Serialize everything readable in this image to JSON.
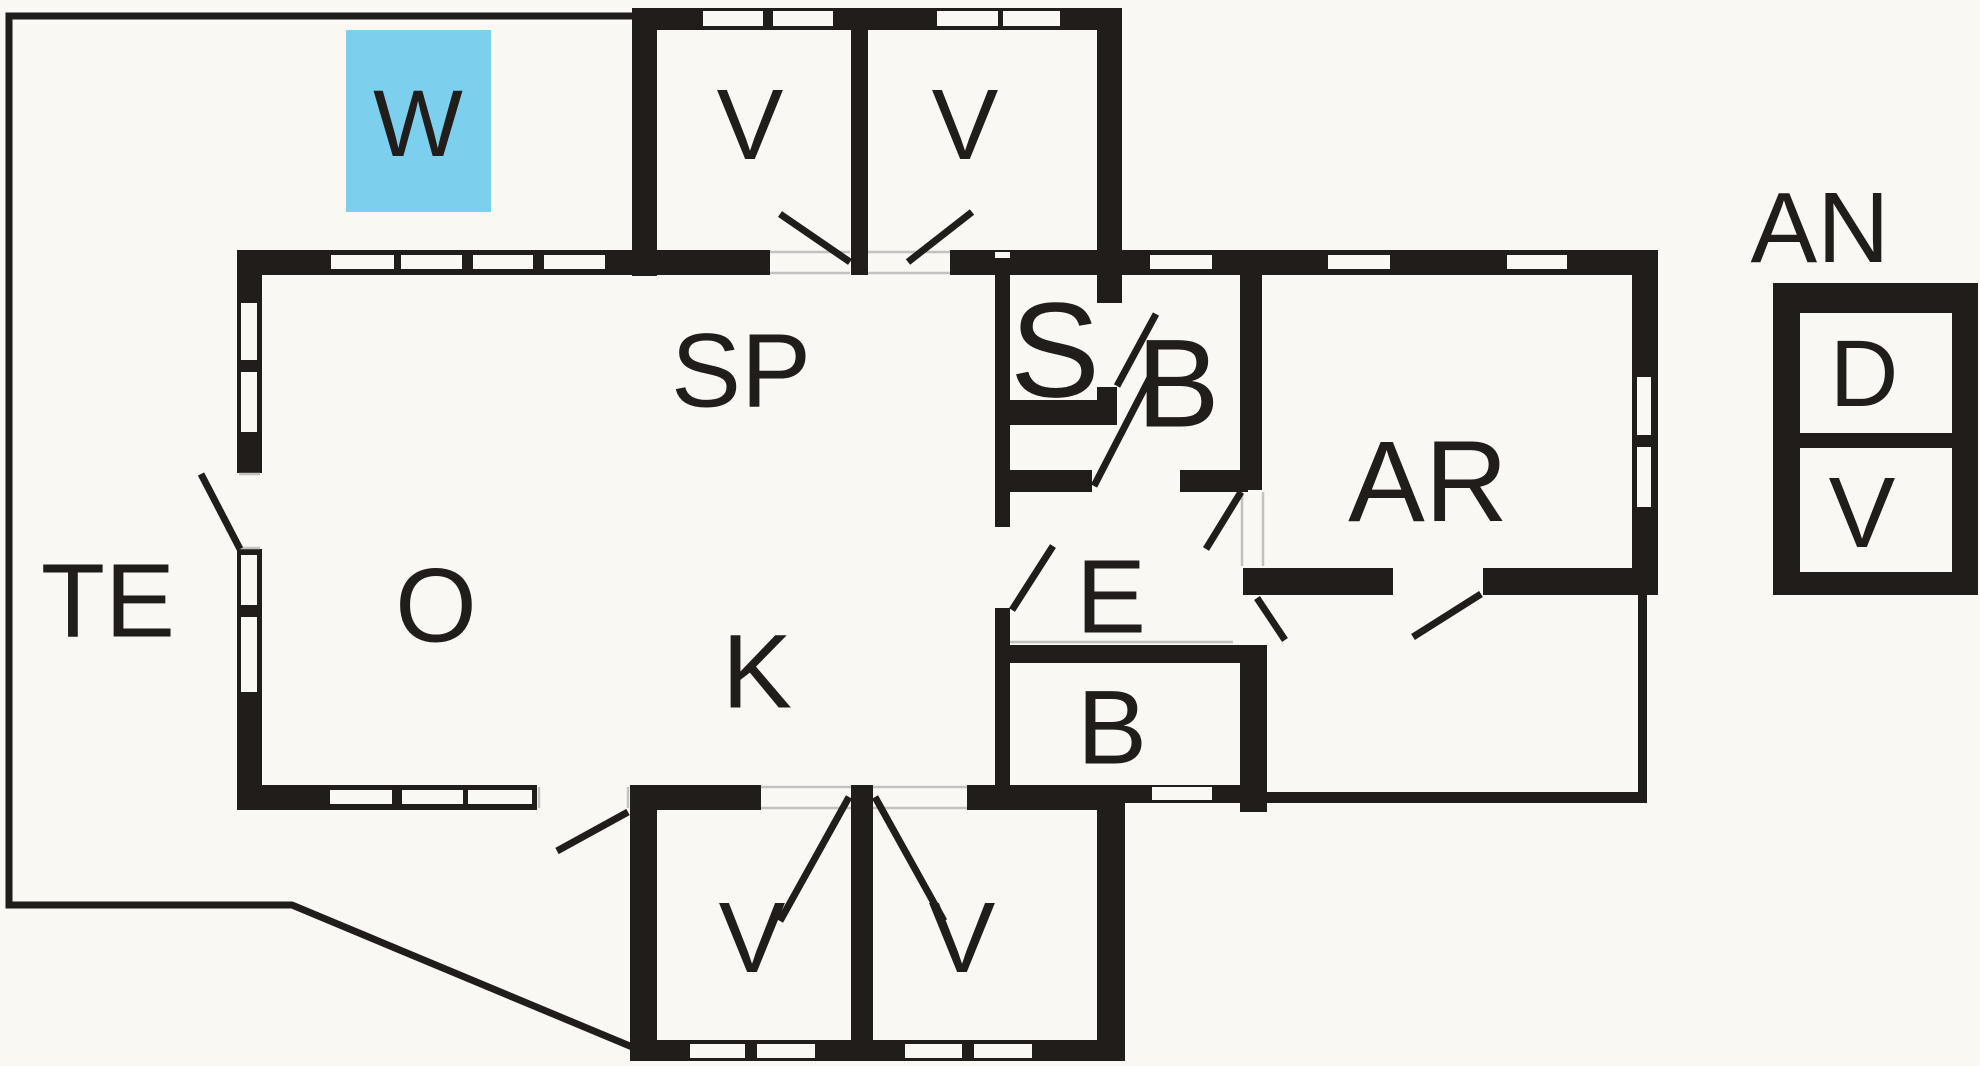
{
  "document": {
    "kind": "architectural floor plan",
    "units": "rooms labeled by letter codes"
  },
  "colors": {
    "wall": "#201D1B",
    "floor": "#FAF8F2",
    "highlight": "#7DCFEE",
    "guide": "#C4C2BF"
  },
  "rooms": [
    {
      "id": "te",
      "label": "TE"
    },
    {
      "id": "w",
      "label": "W"
    },
    {
      "id": "o",
      "label": "O"
    },
    {
      "id": "sp",
      "label": "SP"
    },
    {
      "id": "k",
      "label": "K"
    },
    {
      "id": "v-top-left",
      "label": "V"
    },
    {
      "id": "v-top-right",
      "label": "V"
    },
    {
      "id": "s",
      "label": "S"
    },
    {
      "id": "b-top",
      "label": "B"
    },
    {
      "id": "e",
      "label": "E"
    },
    {
      "id": "b-bottom",
      "label": "B"
    },
    {
      "id": "v-bottom-left",
      "label": "V"
    },
    {
      "id": "v-bottom-right",
      "label": "V"
    },
    {
      "id": "ar",
      "label": "AR"
    },
    {
      "id": "an",
      "label": "AN"
    },
    {
      "id": "an-d",
      "label": "D"
    },
    {
      "id": "an-v",
      "label": "V"
    }
  ]
}
